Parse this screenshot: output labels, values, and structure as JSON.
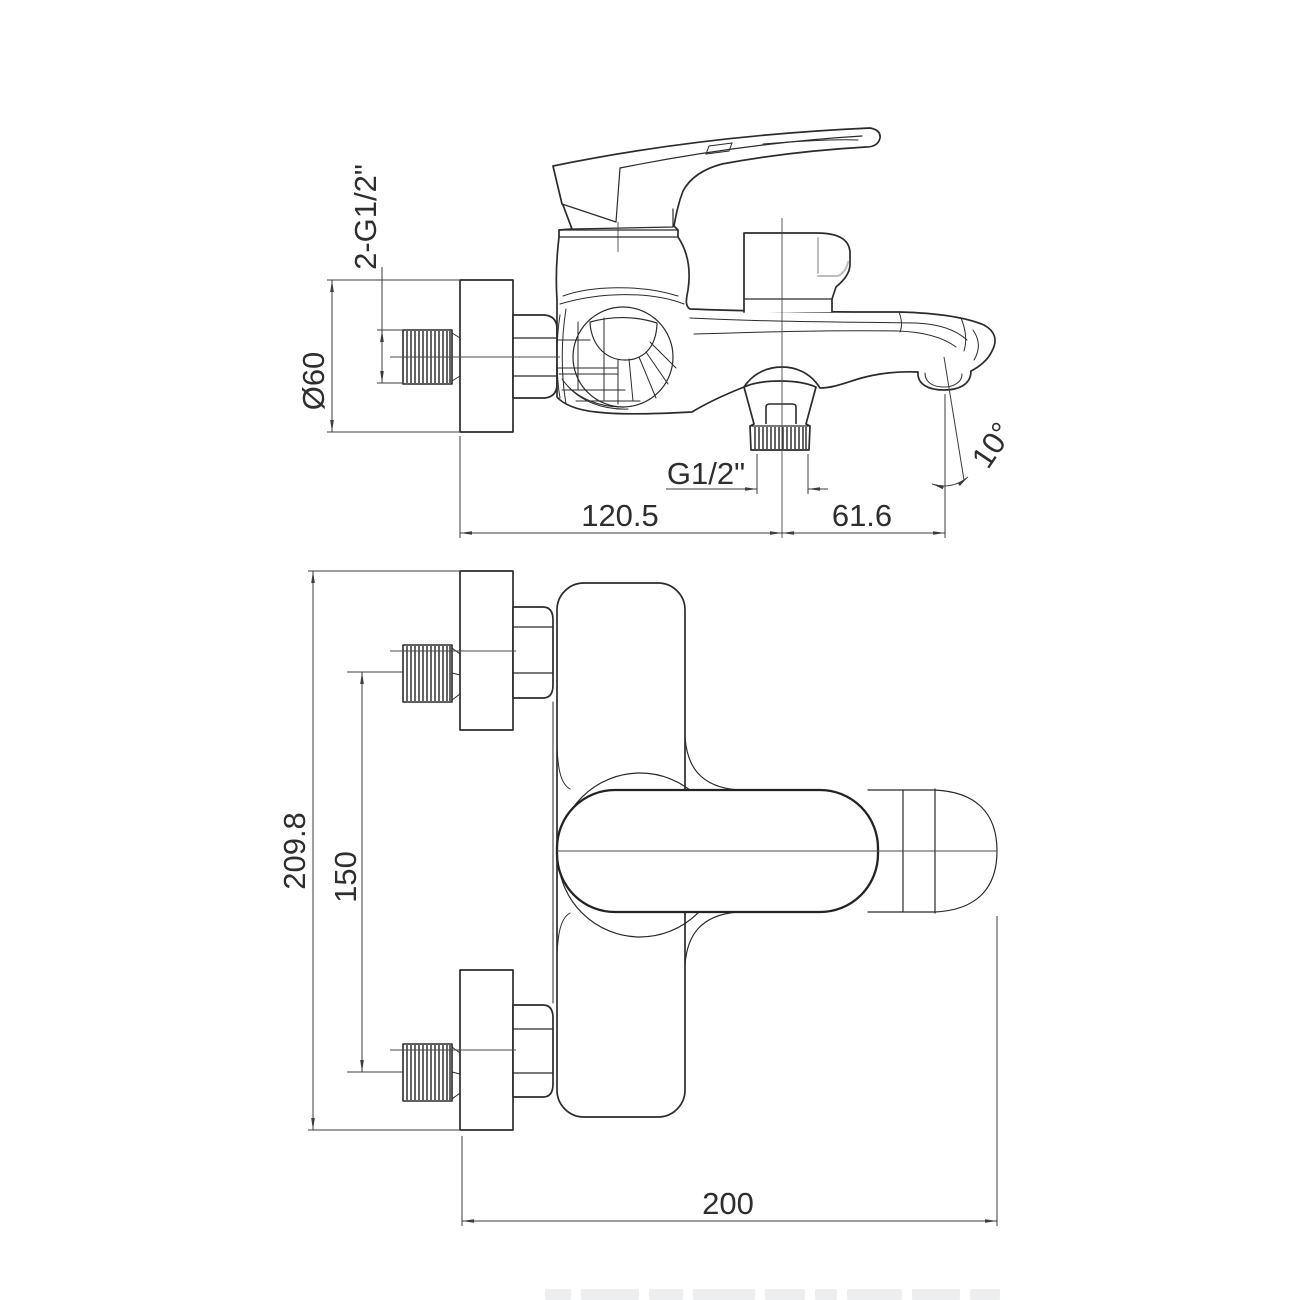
{
  "document": {
    "type": "technical-drawing",
    "subject": "wall-mounted bath mixer faucet, two orthographic views"
  },
  "dims": {
    "two_g12": {
      "label": "2-G1/2\""
    },
    "d60": {
      "label": "Ø60"
    },
    "g12": {
      "label": "G1/2\""
    },
    "len120": {
      "label": "120.5"
    },
    "len61": {
      "label": "61.6"
    },
    "ang10": {
      "label": "10°"
    },
    "h209": {
      "label": "209.8"
    },
    "c150": {
      "label": "150"
    },
    "w200": {
      "label": "200"
    }
  },
  "colors": {
    "line": "#2b2b2b",
    "dim": "#3c3c3c",
    "highlight": "#bdbdbd",
    "background": "#ffffff"
  }
}
